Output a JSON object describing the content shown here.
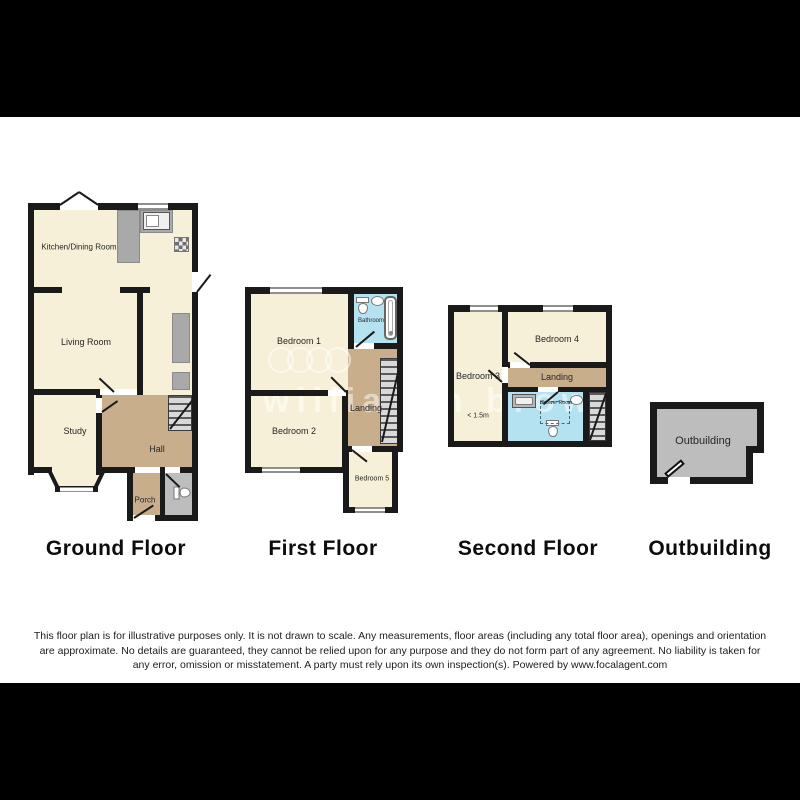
{
  "watermark": {
    "text": "william h brown"
  },
  "floors": {
    "ground": {
      "title": "Ground Floor",
      "rooms": {
        "kitchen": "Kitchen/Dining Room",
        "living": "Living Room",
        "study": "Study",
        "hall": "Hall",
        "porch": "Porch"
      }
    },
    "first": {
      "title": "First Floor",
      "rooms": {
        "bedroom1": "Bedroom 1",
        "bathroom": "Bathroom",
        "landing": "Landing",
        "bedroom2": "Bedroom 2",
        "bedroom5": "Bedroom 5"
      }
    },
    "second": {
      "title": "Second Floor",
      "rooms": {
        "bedroom3": "Bedroom 3",
        "bedroom4": "Bedroom 4",
        "landing": "Landing",
        "shower": "Shower Room",
        "height_note": "< 1.5m"
      }
    },
    "outbuilding": {
      "title": "Outbuilding",
      "rooms": {
        "outbuilding": "Outbuilding"
      }
    }
  },
  "colors": {
    "room_fill": "#F6F0D8",
    "hall_fill": "#C9AE8C",
    "bath_fill": "#B5E2F0",
    "gray_fill": "#BDBDBD",
    "counter_fill": "#A9A9A9",
    "wall": "#1A1A1A"
  },
  "disclaimer": {
    "text": "This floor plan is for illustrative purposes only. It is not drawn to scale. Any measurements, floor areas (including any total floor area), openings and orientation are approximate. No details are guaranteed, they cannot be relied upon for any purpose and they do not form part of any agreement. No liability is taken for any error, omission or misstatement. A party must rely upon its own inspection(s). Powered by www.focalagent.com"
  }
}
